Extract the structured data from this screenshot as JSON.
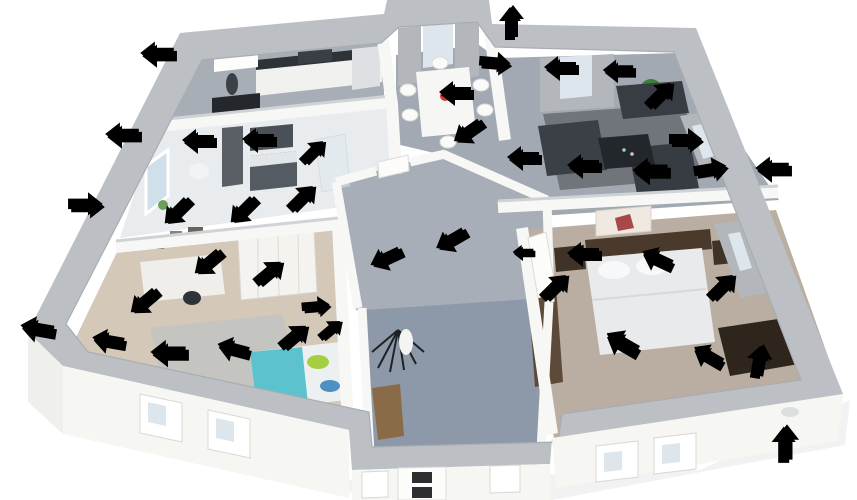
{
  "scene": {
    "type": "isometric-3d-floorplan-cutaway",
    "background": "#ffffff",
    "rooms": [
      {
        "id": "kitchen",
        "furniture": [
          "counter-row",
          "upper-cabinet",
          "range-hood",
          "fridge",
          "dark-table-chairs",
          "water-heater-cylinder"
        ]
      },
      {
        "id": "bathroom",
        "furniture": [
          "tall-cabinet",
          "mirror",
          "vanity-sink",
          "toilet",
          "shower-glass",
          "window-flowers"
        ]
      },
      {
        "id": "kids-room",
        "furniture": [
          "wall-pictures",
          "desk",
          "desk-chair",
          "wardrobe",
          "bed-teal",
          "rug"
        ]
      },
      {
        "id": "dining-room",
        "furniture": [
          "white-table",
          "white-chairs",
          "flower-vase",
          "curtained-windows"
        ]
      },
      {
        "id": "living-room",
        "furniture": [
          "sofa-top",
          "sofa-left",
          "sofa-right",
          "coffee-table",
          "area-rug",
          "potted-plant",
          "curtained-windows"
        ]
      },
      {
        "id": "bedroom",
        "furniture": [
          "double-bed",
          "headboard",
          "nightstand-left",
          "nightstand-right",
          "wall-picture",
          "dresser",
          "wood-bench",
          "curtained-window"
        ]
      },
      {
        "id": "hallway",
        "furniture": [
          "coat-rack",
          "doors"
        ]
      },
      {
        "id": "entrance-hall",
        "furniture": [
          "wood-bench",
          "front-door"
        ]
      }
    ]
  },
  "palette": {
    "wall_top": "#bcc0c4",
    "wall_face": "#f6f6f3",
    "wall_face_shade": "#eeeeea",
    "interior_wall": "#f7f7f5",
    "floor_kitchen": "#a8aeb6",
    "floor_bathroom": "#e9ecef",
    "floor_kids": "#d4c8b9",
    "floor_living": "#a2a9b2",
    "floor_hall": "#a7aeb8",
    "floor_entrance": "#8d99a9",
    "floor_bedroom": "#b9aea1",
    "heat_arrow": "#f04438",
    "heat_arrow_shadow": "#b02a20",
    "cold_arrow": "#4250c8",
    "cold_arrow_shadow": "#2b379b"
  },
  "arrows": {
    "heat_leaks": [
      {
        "x": 198,
        "y": 140,
        "angle": 0,
        "scale": 1
      },
      {
        "x": 258,
        "y": 139,
        "angle": 0,
        "scale": 1
      },
      {
        "x": 316,
        "y": 152,
        "angle": 135,
        "scale": 0.9
      },
      {
        "x": 305,
        "y": 198,
        "angle": 135,
        "scale": 1
      },
      {
        "x": 176,
        "y": 212,
        "angle": -45,
        "scale": 1
      },
      {
        "x": 242,
        "y": 211,
        "angle": -45,
        "scale": 1
      },
      {
        "x": 455,
        "y": 92,
        "angle": 0,
        "scale": 1
      },
      {
        "x": 467,
        "y": 132,
        "angle": -35,
        "scale": 1
      },
      {
        "x": 497,
        "y": 65,
        "angle": 185,
        "scale": 0.95
      },
      {
        "x": 560,
        "y": 67,
        "angle": 0,
        "scale": 1
      },
      {
        "x": 618,
        "y": 70,
        "angle": 0,
        "scale": 0.95
      },
      {
        "x": 663,
        "y": 95,
        "angle": 135,
        "scale": 1
      },
      {
        "x": 688,
        "y": 142,
        "angle": 180,
        "scale": 1
      },
      {
        "x": 713,
        "y": 171,
        "angle": 170,
        "scale": 1
      },
      {
        "x": 650,
        "y": 170,
        "angle": 0,
        "scale": 1.1
      },
      {
        "x": 583,
        "y": 165,
        "angle": 0,
        "scale": 1
      },
      {
        "x": 523,
        "y": 157,
        "angle": 0,
        "scale": 1
      },
      {
        "x": 450,
        "y": 240,
        "angle": -30,
        "scale": 1
      },
      {
        "x": 385,
        "y": 258,
        "angle": -25,
        "scale": 1
      },
      {
        "x": 523,
        "y": 252,
        "angle": 0,
        "scale": 0.65
      },
      {
        "x": 583,
        "y": 253,
        "angle": 0,
        "scale": 1
      },
      {
        "x": 657,
        "y": 258,
        "angle": 25,
        "scale": 1
      },
      {
        "x": 558,
        "y": 287,
        "angle": 135,
        "scale": 1
      },
      {
        "x": 725,
        "y": 287,
        "angle": 135,
        "scale": 1
      },
      {
        "x": 622,
        "y": 342,
        "angle": 30,
        "scale": 1.1
      },
      {
        "x": 708,
        "y": 355,
        "angle": 30,
        "scale": 1
      },
      {
        "x": 761,
        "y": 360,
        "angle": 100,
        "scale": 1
      },
      {
        "x": 207,
        "y": 263,
        "angle": -40,
        "scale": 1
      },
      {
        "x": 143,
        "y": 302,
        "angle": -40,
        "scale": 1
      },
      {
        "x": 272,
        "y": 273,
        "angle": 140,
        "scale": 1
      },
      {
        "x": 318,
        "y": 308,
        "angle": 175,
        "scale": 0.85
      },
      {
        "x": 108,
        "y": 340,
        "angle": 10,
        "scale": 1
      },
      {
        "x": 168,
        "y": 352,
        "angle": 0,
        "scale": 1.1
      },
      {
        "x": 233,
        "y": 348,
        "angle": 15,
        "scale": 1
      },
      {
        "x": 297,
        "y": 337,
        "angle": 140,
        "scale": 1
      },
      {
        "x": 333,
        "y": 330,
        "angle": 140,
        "scale": 0.8
      }
    ],
    "cold_drafts": [
      {
        "x": 157,
        "y": 53,
        "angle": 0,
        "scale": 1.05
      },
      {
        "x": 122,
        "y": 134,
        "angle": 0,
        "scale": 1.05
      },
      {
        "x": 88,
        "y": 207,
        "angle": 180,
        "scale": 1.05
      },
      {
        "x": 37,
        "y": 328,
        "angle": 10,
        "scale": 1.05
      },
      {
        "x": 513,
        "y": 21,
        "angle": 90,
        "scale": 1
      },
      {
        "x": 772,
        "y": 168,
        "angle": 0,
        "scale": 1.05
      },
      {
        "x": 787,
        "y": 442,
        "angle": 90,
        "scale": 1.1
      }
    ]
  }
}
